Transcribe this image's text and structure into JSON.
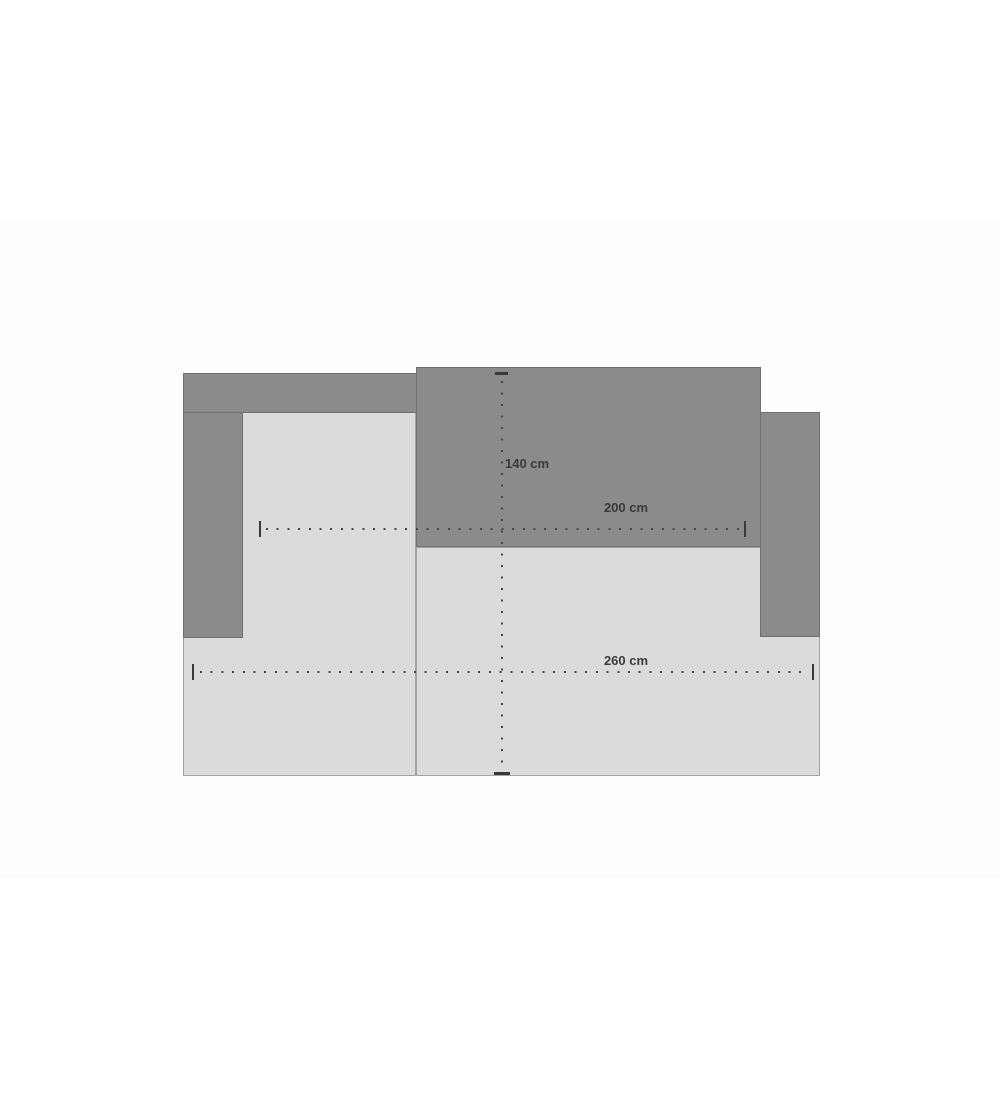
{
  "page": {
    "background_color": "#ffffff",
    "image_area_tint": "#fdfdfd"
  },
  "diagram": {
    "kind": "sectional-sofa-top-view-dimension-drawing",
    "colors": {
      "dark_panel_fill": "#8b8b8b",
      "dark_panel_border": "#6f6f6f",
      "light_panel_fill": "#dbdbdb",
      "light_panel_border": "#a2a2a2",
      "dimension_line": "#454545",
      "label_text": "#3a3a3a"
    },
    "dimensions": {
      "depth": {
        "label": "140 cm",
        "orientation": "vertical"
      },
      "sofa_width": {
        "label": "200 cm",
        "orientation": "horizontal"
      },
      "total_width": {
        "label": "260 cm",
        "orientation": "horizontal"
      }
    }
  }
}
